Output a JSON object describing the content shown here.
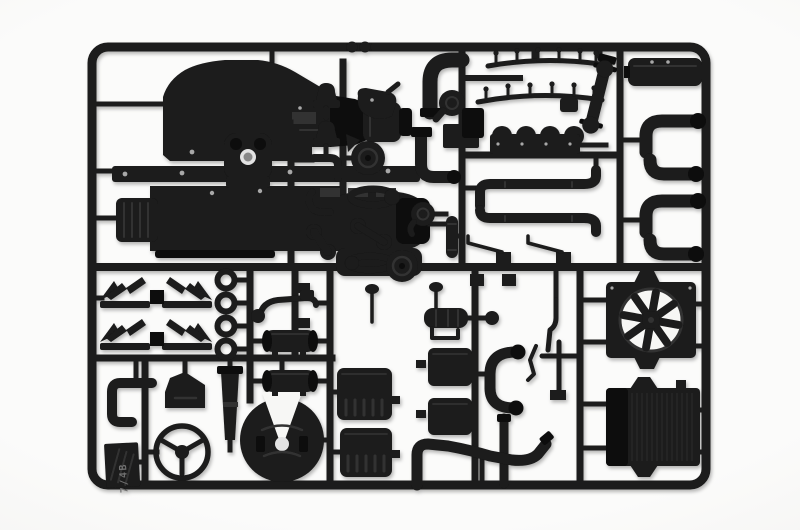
{
  "image": {
    "type": "product-photo",
    "subject": "black injection-molded plastic model kit sprue with truck engine and chassis parts on white background",
    "sprue_tag": "7/4B",
    "colors": {
      "bg": "#f7f7f5",
      "plastic": "#1a1a1a",
      "plastic-dark": "#0d0d0d",
      "hl": "#333333",
      "glint": "#a8a8a8",
      "hole": "#e3e3e3"
    },
    "parts": [
      {
        "name": "engine-block-half",
        "qty": 2
      },
      {
        "name": "engine-mounting-plate",
        "qty": 1
      },
      {
        "name": "gearbox-cover",
        "qty": 1
      },
      {
        "name": "wiring-harness-rail",
        "qty": 2
      },
      {
        "name": "valve-cover",
        "qty": 2
      },
      {
        "name": "drive-shaft",
        "qty": 1
      },
      {
        "name": "intake-elbow",
        "qty": 4
      },
      {
        "name": "exhaust-pipe-straight",
        "qty": 2
      },
      {
        "name": "elbow-pipe-large",
        "qty": 1
      },
      {
        "name": "l-bend-pipe",
        "qty": 2
      },
      {
        "name": "turbocharger",
        "qty": 2
      },
      {
        "name": "pulley",
        "qty": 2
      },
      {
        "name": "drive-belt-loop",
        "qty": 2
      },
      {
        "name": "belt-tensioner",
        "qty": 1
      },
      {
        "name": "air-filter-bell",
        "qty": 2
      },
      {
        "name": "brake-drum",
        "qty": 1
      },
      {
        "name": "air-dryer-cylinder",
        "qty": 1
      },
      {
        "name": "mud-flap-bracket",
        "qty": 4
      },
      {
        "name": "washer-ring",
        "qty": 4
      },
      {
        "name": "steering-wheel",
        "qty": 1
      },
      {
        "name": "fifth-wheel-coupling",
        "qty": 1
      },
      {
        "name": "exhaust-stack",
        "qty": 1
      },
      {
        "name": "cab-mount-wedge",
        "qty": 1
      },
      {
        "name": "air-tank",
        "qty": 2
      },
      {
        "name": "tank-bracket",
        "qty": 1
      },
      {
        "name": "battery-step-panel",
        "qty": 2
      },
      {
        "name": "box-panel",
        "qty": 2
      },
      {
        "name": "c-shaped-hose",
        "qty": 1
      },
      {
        "name": "small-muffler",
        "qty": 1
      },
      {
        "name": "mirror-stalk",
        "qty": 2
      },
      {
        "name": "gear-lever",
        "qty": 2
      },
      {
        "name": "linkage-cross",
        "qty": 1
      },
      {
        "name": "s-bend-exhaust-pipe",
        "qty": 1
      },
      {
        "name": "down-pipe",
        "qty": 1
      },
      {
        "name": "cooling-fan-with-shroud",
        "qty": 1
      },
      {
        "name": "radiator",
        "qty": 1
      },
      {
        "name": "pipe-coupler",
        "qty": 1
      }
    ]
  }
}
